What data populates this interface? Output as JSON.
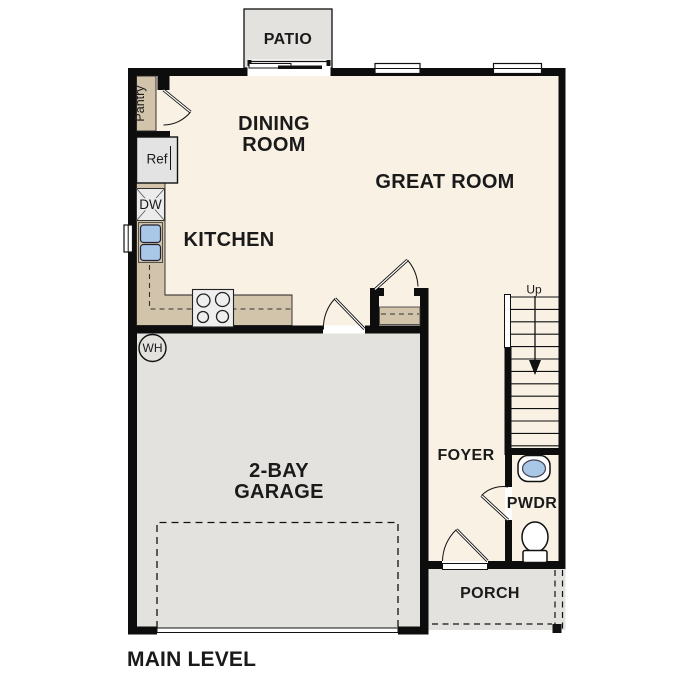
{
  "title": "MAIN LEVEL",
  "rooms": {
    "patio": "PATIO",
    "dining": {
      "line1": "DINING",
      "line2": "ROOM"
    },
    "great_room": "GREAT ROOM",
    "kitchen": "KITCHEN",
    "garage": {
      "line1": "2-BAY",
      "line2": "GARAGE"
    },
    "foyer": "FOYER",
    "powder_room": "PWDR",
    "porch": "PORCH"
  },
  "fixtures": {
    "pantry": "Pantry",
    "refrigerator": "Ref",
    "dishwasher": "DW",
    "water_heater": "WH",
    "stair_direction": "Up"
  },
  "colors": {
    "background": "#ffffff",
    "floor": "#f8f1e4",
    "concrete": "#e3e2df",
    "casework": "#d1c4aa",
    "sink_basin": "#a9c7e6",
    "wall": "#0d0d0d",
    "label_text": "#1a1a1a"
  }
}
